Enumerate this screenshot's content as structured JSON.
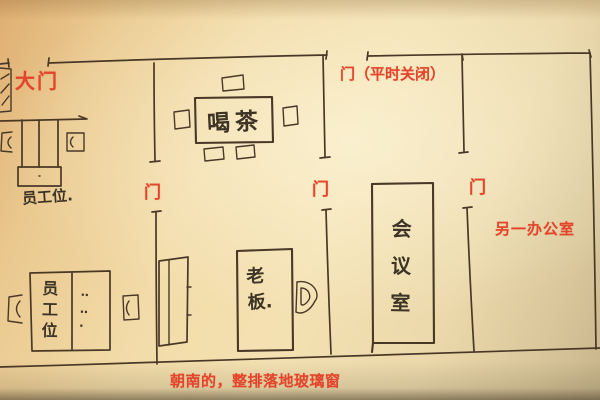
{
  "title": "hand-drawn office floor plan sketch",
  "palette": {
    "paper_light": "#f4e1b2",
    "paper_dark": "#dfae72",
    "ink": "#4a3827",
    "annotation_red": "#e2452b"
  },
  "labels": {
    "main_door": "大门",
    "top_door": "门（平时关闭）",
    "doors": [
      "门",
      "门",
      "门"
    ],
    "other_office": "另一办公室",
    "south_windows": "朝南的，整排落地玻璃窗",
    "reception_seat": "员工位.",
    "tea_table": "喝茶",
    "staff_seat": "员工位",
    "staff_seat_dots": "‥\n‥\n·",
    "boss": "老板.",
    "meeting_room": "会议室"
  }
}
